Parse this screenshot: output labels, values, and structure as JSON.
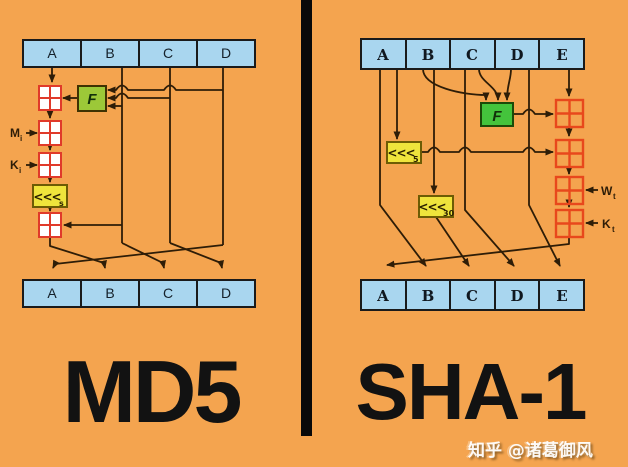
{
  "panels": {
    "md5": {
      "title": "MD5",
      "registers_top": [
        "A",
        "B",
        "C",
        "D"
      ],
      "registers_bottom": [
        "A",
        "B",
        "C",
        "D"
      ],
      "f_label": "F",
      "shift_label": "<<<",
      "shift_sub": "s",
      "m_label": "M",
      "m_sub": "i",
      "k_label": "K",
      "k_sub": "i"
    },
    "sha1": {
      "title": "SHA-1",
      "registers_top": [
        "A",
        "B",
        "C",
        "D",
        "E"
      ],
      "registers_bottom": [
        "A",
        "B",
        "C",
        "D",
        "E"
      ],
      "f_label": "F",
      "shift5_label": "<<<",
      "shift5_sub": "5",
      "shift30_label": "<<<",
      "shift30_sub": "30",
      "w_label": "W",
      "w_sub": "t",
      "k_label": "K",
      "k_sub": "t"
    }
  },
  "watermark": "知乎 @诸葛御风",
  "colors": {
    "background": "#F4A44F",
    "register_fill": "#A9D6EF",
    "md5_f_fill": "#9CC838",
    "sha1_f_fill": "#44C43C",
    "shift_fill": "#EFE43C",
    "adder_red": "#E03A2A",
    "wire": "#2E1D07",
    "divider": "#090909",
    "title_text": "#121212"
  }
}
